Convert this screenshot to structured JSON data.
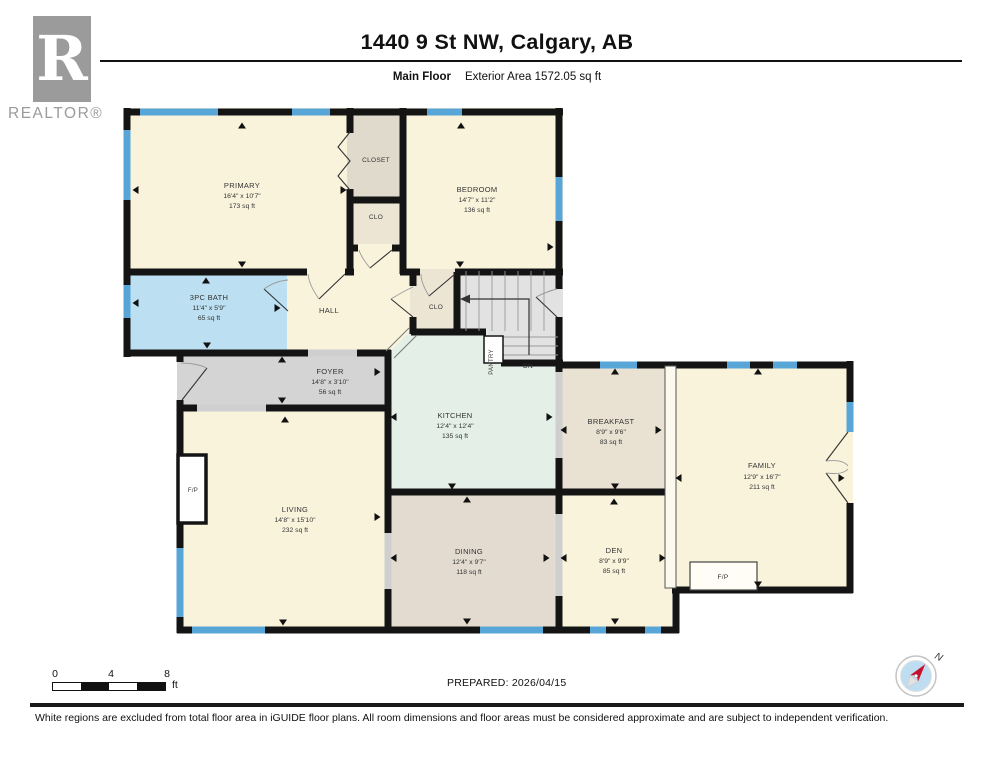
{
  "header": {
    "title": "1440 9 St NW, Calgary, AB",
    "floor_label": "Main Floor",
    "area_label": "Exterior Area 1572.05 sq ft"
  },
  "logo": {
    "letter": "R",
    "wordmark": "REALTOR®"
  },
  "rooms": {
    "primary": {
      "name": "PRIMARY",
      "dims": "16'4\" x 10'7\"",
      "area": "173 sq ft"
    },
    "bedroom": {
      "name": "BEDROOM",
      "dims": "14'7\" x 11'2\"",
      "area": "136 sq ft"
    },
    "bath": {
      "name": "3PC BATH",
      "dims": "11'4\" x 5'9\"",
      "area": "65 sq ft"
    },
    "hall": {
      "name": "HALL"
    },
    "foyer": {
      "name": "FOYER",
      "dims": "14'8\" x 3'10\"",
      "area": "56 sq ft"
    },
    "kitchen": {
      "name": "KITCHEN",
      "dims": "12'4\" x 12'4\"",
      "area": "135 sq ft"
    },
    "breakfast": {
      "name": "BREAKFAST",
      "dims": "8'9\" x 9'6\"",
      "area": "83 sq ft"
    },
    "family": {
      "name": "FAMILY",
      "dims": "12'9\" x 16'7\"",
      "area": "211 sq ft"
    },
    "living": {
      "name": "LIVING",
      "dims": "14'8\" x 15'10\"",
      "area": "232 sq ft"
    },
    "dining": {
      "name": "DINING",
      "dims": "12'4\" x 9'7\"",
      "area": "118 sq ft"
    },
    "den": {
      "name": "DEN",
      "dims": "8'9\" x 9'9\"",
      "area": "85 sq ft"
    },
    "closet": {
      "name": "CLOSET"
    },
    "clo_upper": {
      "name": "CLO"
    },
    "clo_stairs": {
      "name": "CLO"
    },
    "pantry": {
      "name": "PANTRY"
    },
    "stairs_dn": {
      "name": "DN"
    },
    "fireplace_living": {
      "name": "F/P"
    },
    "fireplace_family": {
      "name": "F/P"
    }
  },
  "scale_bar": {
    "tick0": "0",
    "tick1": "4",
    "tick2": "8",
    "unit": "ft"
  },
  "compass": {
    "north_label": "N"
  },
  "footer": {
    "prepared": "PREPARED: 2026/04/15",
    "disclaimer": "White regions are excluded from total floor area in iGUIDE floor plans. All room dimensions and floor areas must be considered approximate and are subject to independent verification."
  },
  "colors": {
    "room_cream": "#FAF3DC",
    "bath_blue": "#BCE0F2",
    "window_blue": "#58A6D8",
    "foyer_gray": "#D4D4D4",
    "dining_tan": "#E3DBD0",
    "breakfast_tan": "#E9E1D2",
    "kitchen_mint": "#E4EFE7",
    "closet_gray": "#DFDACB",
    "stairs_gray": "#E2E2E2",
    "wall": "#141414"
  }
}
